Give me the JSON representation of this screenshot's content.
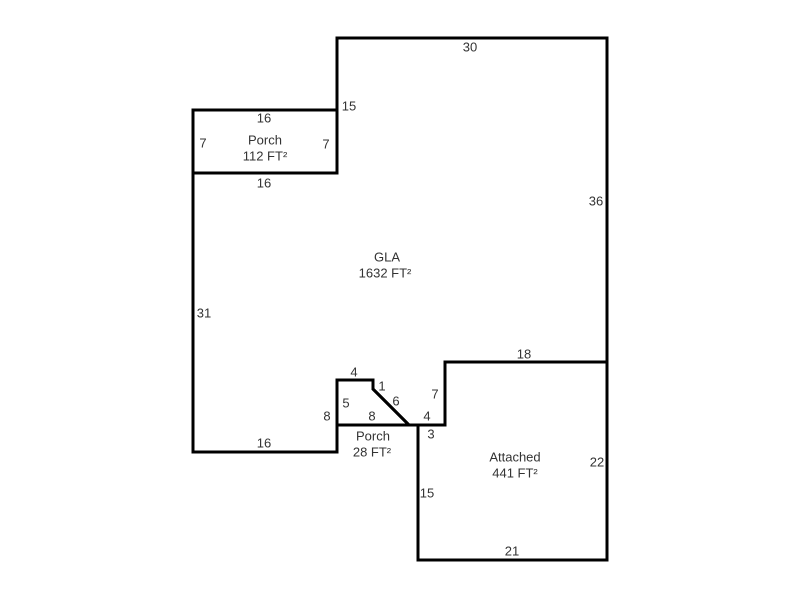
{
  "canvas": {
    "width": 800,
    "height": 600,
    "background": "#ffffff"
  },
  "sketch": {
    "units": "FT",
    "scale_px_per_ft": 9,
    "origin_px": {
      "x": 193,
      "y": 38
    },
    "style": {
      "wall_color": "#000000",
      "wall_width": 3,
      "text_color": "#333333",
      "font_size": 13,
      "label_line_spacing": 16
    },
    "areas": [
      {
        "id": "gla",
        "name": "GLA",
        "size": "1632 FT²",
        "name_pos": {
          "x": 387,
          "y": 257
        },
        "size_pos": {
          "x": 385,
          "y": 273
        },
        "vertices_ft": [
          [
            16,
            0
          ],
          [
            46,
            0
          ],
          [
            46,
            36
          ],
          [
            28,
            36
          ],
          [
            28,
            43
          ],
          [
            24,
            43
          ],
          [
            20,
            39
          ],
          [
            20,
            38
          ],
          [
            16,
            38
          ],
          [
            16,
            46
          ],
          [
            0,
            46
          ],
          [
            0,
            15
          ],
          [
            16,
            15
          ]
        ]
      },
      {
        "id": "porch-front",
        "name": "Porch",
        "size": "112 FT²",
        "name_pos": {
          "x": 265,
          "y": 140
        },
        "size_pos": {
          "x": 265,
          "y": 156
        },
        "vertices_ft": [
          [
            0,
            8
          ],
          [
            16,
            8
          ],
          [
            16,
            15
          ],
          [
            0,
            15
          ]
        ]
      },
      {
        "id": "porch-rear",
        "name": "Porch",
        "size": "28 FT²",
        "name_pos": {
          "x": 373,
          "y": 436
        },
        "size_pos": {
          "x": 372,
          "y": 452
        },
        "vertices_ft": [
          [
            16,
            38
          ],
          [
            20,
            38
          ],
          [
            20,
            39
          ],
          [
            24,
            43
          ],
          [
            16,
            43
          ]
        ]
      },
      {
        "id": "attached-garage",
        "name": "Attached",
        "size": "441 FT²",
        "name_pos": {
          "x": 515,
          "y": 457
        },
        "size_pos": {
          "x": 515,
          "y": 473
        },
        "vertices_ft": [
          [
            28,
            36
          ],
          [
            46,
            36
          ],
          [
            46,
            58
          ],
          [
            25,
            58
          ],
          [
            25,
            43
          ],
          [
            28,
            43
          ]
        ]
      }
    ],
    "dimension_labels": [
      {
        "text": "30",
        "x": 470,
        "y": 47
      },
      {
        "text": "15",
        "x": 349,
        "y": 106
      },
      {
        "text": "16",
        "x": 264,
        "y": 118
      },
      {
        "text": "7",
        "x": 203,
        "y": 143
      },
      {
        "text": "7",
        "x": 326,
        "y": 144
      },
      {
        "text": "16",
        "x": 264,
        "y": 183
      },
      {
        "text": "36",
        "x": 596,
        "y": 201
      },
      {
        "text": "31",
        "x": 204,
        "y": 313
      },
      {
        "text": "18",
        "x": 524,
        "y": 354
      },
      {
        "text": "4",
        "x": 354,
        "y": 372
      },
      {
        "text": "1",
        "x": 382,
        "y": 386
      },
      {
        "text": "7",
        "x": 435,
        "y": 394
      },
      {
        "text": "6",
        "x": 396,
        "y": 401
      },
      {
        "text": "5",
        "x": 346,
        "y": 403
      },
      {
        "text": "8",
        "x": 327,
        "y": 416
      },
      {
        "text": "8",
        "x": 372,
        "y": 416
      },
      {
        "text": "4",
        "x": 427,
        "y": 416
      },
      {
        "text": "3",
        "x": 431,
        "y": 434
      },
      {
        "text": "16",
        "x": 264,
        "y": 443
      },
      {
        "text": "22",
        "x": 597,
        "y": 462
      },
      {
        "text": "15",
        "x": 427,
        "y": 493
      },
      {
        "text": "21",
        "x": 512,
        "y": 551
      }
    ]
  }
}
